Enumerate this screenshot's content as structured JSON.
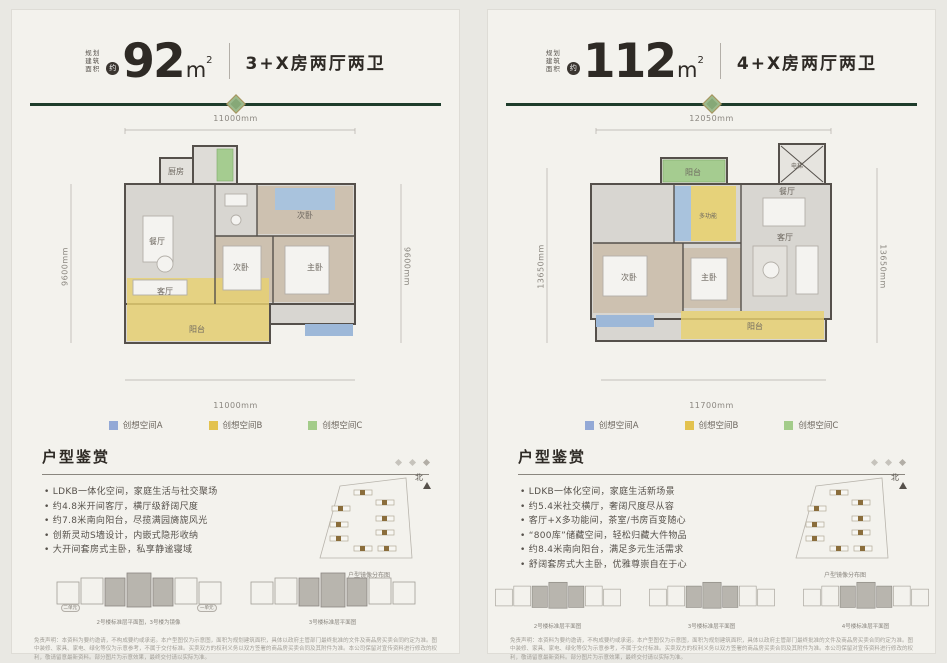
{
  "colors": {
    "accent_green": "#1e3c2b",
    "legend_a": "#93a9d6",
    "legend_b": "#e3c24e",
    "legend_c": "#a3cc8a",
    "zone_blue": "#9db8d8",
    "zone_yellow": "#e8d170",
    "zone_green": "#a5cc90"
  },
  "left": {
    "area_prefix": [
      "规划",
      "建筑",
      "面积"
    ],
    "approx": "约",
    "area_value": "92",
    "area_unit": "m",
    "area_sup": "2",
    "layout_desc": "3+X房两厅两卫",
    "dims": {
      "top": "11000mm",
      "bottom": "11000mm",
      "left": "9600mm",
      "right": "9600mm"
    },
    "rooms": [
      "厨房",
      "餐厅",
      "客厅",
      "阳台",
      "次卧",
      "次卧",
      "主卧"
    ],
    "legend": [
      {
        "label": "创想空间A",
        "color": "#93a9d6"
      },
      {
        "label": "创想空间B",
        "color": "#e3c24e"
      },
      {
        "label": "创想空间C",
        "color": "#a3cc8a"
      }
    ],
    "section_title": "户型鉴赏",
    "bullets": [
      "LDKB一体化空间，家庭生活与社交聚场",
      "约4.8米开间客厅，横厅级舒阔尺度",
      "约7.8米南向阳台，尽揽满园旖旎风光",
      "创新灵动S墙设计，内嵌式隐形收纳",
      "大开间套房式主卧，私享静谧寝域"
    ],
    "north_label": "北",
    "site_caption": "户型镜像分布图",
    "minis": [
      {
        "caption": "2号楼标准层平面图，3号楼为镜像",
        "units": [
          "二单元",
          "一单元"
        ]
      },
      {
        "caption": "3号楼标准层平面图"
      }
    ],
    "disclaimer": "免责声明：本资料为要约邀请，不构成要约或承诺。本户型图仅为示意图，面积为规划建筑面积，具体以政府主管部门最终批准的文件及商品房买卖合同约定为准。图中装修、家具、家电、绿化等仅为示意参考，不属于交付标准。买卖双方的权利义务以双方签署的商品房买卖合同及其附件为准。本公司保留对宣传资料进行修改的权利，敬请留意最新资料。部分图片为示意效果，最终交付请以实际为准。"
  },
  "right": {
    "area_prefix": [
      "规划",
      "建筑",
      "面积"
    ],
    "approx": "约",
    "area_value": "112",
    "area_unit": "m",
    "area_sup": "2",
    "layout_desc": "4+X房两厅两卫",
    "dims": {
      "top": "12050mm",
      "bottom": "11700mm",
      "left": "13650mm",
      "right": "13650mm"
    },
    "rooms": [
      "电梯",
      "阳台",
      "多功能",
      "次卧",
      "主卧",
      "餐厅",
      "客厅",
      "阳台"
    ],
    "legend": [
      {
        "label": "创想空间A",
        "color": "#93a9d6"
      },
      {
        "label": "创想空间B",
        "color": "#e3c24e"
      },
      {
        "label": "创想空间C",
        "color": "#a3cc8a"
      }
    ],
    "section_title": "户型鉴赏",
    "bullets": [
      "LDKB一体化空间，家庭生活新场景",
      "约5.4米社交横厅，奢阔尺度尽从容",
      "客厅+X多功能间，茶室/书房百变随心",
      "“800库”储藏空间，轻松归藏大件物品",
      "约8.4米南向阳台，满足多元生活需求",
      "舒阔套房式大主卧，优雅尊崇自在于心"
    ],
    "north_label": "北",
    "site_caption": "户型镜像分布图",
    "minis": [
      {
        "caption": "2号楼标准层平面图"
      },
      {
        "caption": "3号楼标准层平面图"
      },
      {
        "caption": "4号楼标准层平面图"
      }
    ],
    "disclaimer": "免责声明：本资料为要约邀请，不构成要约或承诺。本户型图仅为示意图，面积为规划建筑面积，具体以政府主管部门最终批准的文件及商品房买卖合同约定为准。图中装修、家具、家电、绿化等仅为示意参考，不属于交付标准。买卖双方的权利义务以双方签署的商品房买卖合同及其附件为准。本公司保留对宣传资料进行修改的权利，敬请留意最新资料。部分图片为示意效果，最终交付请以实际为准。"
  }
}
